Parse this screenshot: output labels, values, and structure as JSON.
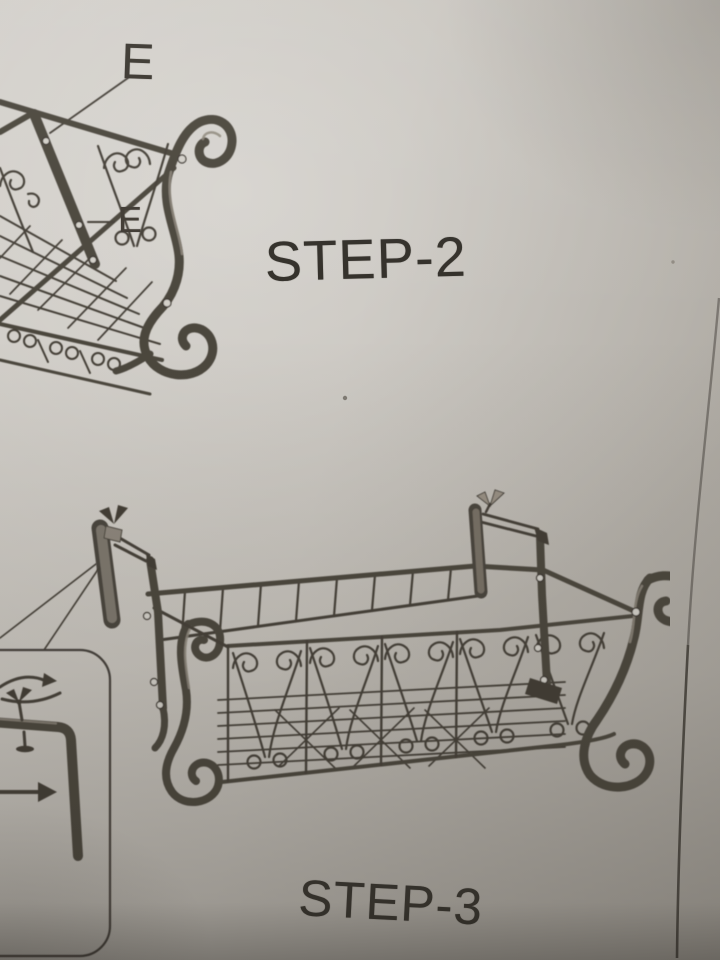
{
  "steps": [
    {
      "label": "STEP-2"
    },
    {
      "label": "STEP-3"
    }
  ],
  "part_labels": {
    "top": "E",
    "middle": "E"
  },
  "colors": {
    "paper": "#c7c3bc",
    "ink": "#433e36",
    "ink_dark": "#332f29",
    "metal_light": "#8d877b",
    "text": "#33302a"
  }
}
